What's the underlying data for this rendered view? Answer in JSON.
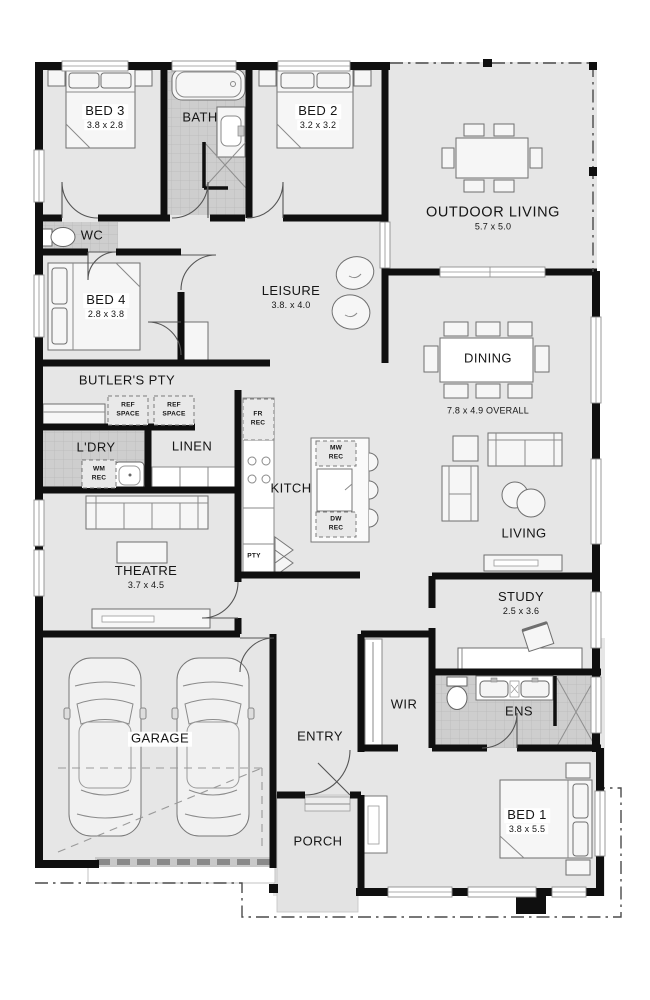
{
  "rooms": {
    "bed3": {
      "name": "BED 3",
      "dims": "3.8 x 2.8"
    },
    "bath": {
      "name": "BATH"
    },
    "bed2": {
      "name": "BED 2",
      "dims": "3.2 x 3.2"
    },
    "outdoor_living": {
      "name": "OUTDOOR LIVING",
      "dims": "5.7 x 5.0"
    },
    "wc": {
      "name": "WC"
    },
    "bed4": {
      "name": "BED 4",
      "dims": "2.8 x 3.8"
    },
    "leisure": {
      "name": "LEISURE",
      "dims": "3.8. x 4.0"
    },
    "butlers_pty": {
      "name": "BUTLER'S PTY"
    },
    "dining": {
      "name": "DINING",
      "dims": "7.8 x 4.9 OVERALL"
    },
    "ldry": {
      "name": "L'DRY"
    },
    "linen": {
      "name": "LINEN"
    },
    "kitch": {
      "name": "KITCH"
    },
    "living": {
      "name": "LIVING"
    },
    "theatre": {
      "name": "THEATRE",
      "dims": "3.7 x 4.5"
    },
    "study": {
      "name": "STUDY",
      "dims": "2.5 x 3.6"
    },
    "garage": {
      "name": "GARAGE"
    },
    "entry": {
      "name": "ENTRY"
    },
    "wir": {
      "name": "WIR"
    },
    "ens": {
      "name": "ENS"
    },
    "bed1": {
      "name": "BED 1",
      "dims": "3.8 x 5.5"
    },
    "porch": {
      "name": "PORCH"
    }
  },
  "fixtures": {
    "ref_space_1": "REF\nSPACE",
    "ref_space_2": "REF\nSPACE",
    "wm_rec": "WM\nREC",
    "fr_rec": "FR\nREC",
    "mw_rec": "MW\nREC",
    "dw_rec": "DW\nREC",
    "pty": "PTY"
  },
  "colors": {
    "wall": "#0f0f0f",
    "floor": "#e6e6e6",
    "tile": "#cecece",
    "boundary": "#4a4a4a"
  }
}
